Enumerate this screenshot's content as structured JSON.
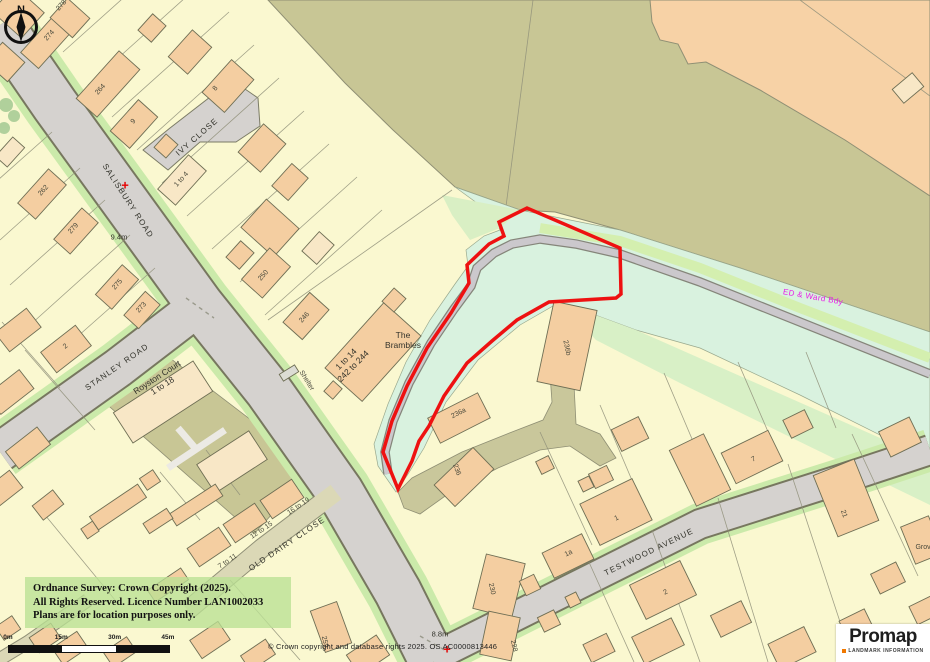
{
  "map": {
    "labels": [
      {
        "text": "SALISBURY ROAD",
        "x": 128,
        "y": 201,
        "rot": 57,
        "cls": "road"
      },
      {
        "text": "STANLEY ROAD",
        "x": 117,
        "y": 367,
        "rot": -35,
        "cls": "road"
      },
      {
        "text": "IVY CLOSE",
        "x": 197,
        "y": 137,
        "rot": -41,
        "cls": "road"
      },
      {
        "text": "OLD DAIRY CLOSE",
        "x": 287,
        "y": 544,
        "rot": -34,
        "cls": "road"
      },
      {
        "text": "TESTWOOD AVENUE",
        "x": 649,
        "y": 552,
        "rot": -26,
        "cls": "road"
      },
      {
        "text": "The\nBrambles",
        "x": 403,
        "y": 341,
        "rot": 0,
        "cls": "place"
      },
      {
        "text": "1 to 14\n242 to 244",
        "x": 350,
        "y": 363,
        "rot": -45,
        "cls": "place"
      },
      {
        "text": "Royston Court\n1 to 18",
        "x": 160,
        "y": 382,
        "rot": -33,
        "cls": "place"
      },
      {
        "text": "Shelter",
        "x": 306,
        "y": 381,
        "rot": 58,
        "cls": "placesm"
      },
      {
        "text": "ED & Ward Bdy",
        "x": 813,
        "y": 297,
        "rot": 10,
        "cls": "bdy"
      },
      {
        "text": "9.4m",
        "x": 119,
        "y": 238,
        "rot": 0,
        "cls": "height"
      },
      {
        "text": "8.8m",
        "x": 440,
        "y": 635,
        "rot": 0,
        "cls": "height"
      },
      {
        "text": "+",
        "x": 125,
        "y": 186,
        "rot": 0,
        "cls": "cross"
      },
      {
        "text": "+",
        "x": 447,
        "y": 650,
        "rot": 0,
        "cls": "cross"
      },
      {
        "text": "278",
        "x": 62,
        "y": 6,
        "rot": -48,
        "cls": "num"
      },
      {
        "text": "274",
        "x": 50,
        "y": 36,
        "rot": -48,
        "cls": "num"
      },
      {
        "text": "264",
        "x": 101,
        "y": 90,
        "rot": -48,
        "cls": "num"
      },
      {
        "text": "8",
        "x": 216,
        "y": 89,
        "rot": -48,
        "cls": "num"
      },
      {
        "text": "9",
        "x": 134,
        "y": 122,
        "rot": -48,
        "cls": "num"
      },
      {
        "text": "1 to 4",
        "x": 182,
        "y": 180,
        "rot": -48,
        "cls": "num"
      },
      {
        "text": "262",
        "x": 44,
        "y": 191,
        "rot": -48,
        "cls": "num"
      },
      {
        "text": "279",
        "x": 74,
        "y": 229,
        "rot": -48,
        "cls": "num"
      },
      {
        "text": "275",
        "x": 118,
        "y": 285,
        "rot": -48,
        "cls": "num"
      },
      {
        "text": "273",
        "x": 142,
        "y": 308,
        "rot": -48,
        "cls": "num"
      },
      {
        "text": "2",
        "x": 66,
        "y": 347,
        "rot": -38,
        "cls": "num"
      },
      {
        "text": "250",
        "x": 264,
        "y": 276,
        "rot": -48,
        "cls": "num"
      },
      {
        "text": "246",
        "x": 305,
        "y": 318,
        "rot": -48,
        "cls": "num"
      },
      {
        "text": "236b",
        "x": 566,
        "y": 348,
        "rot": 78,
        "cls": "num"
      },
      {
        "text": "236a",
        "x": 459,
        "y": 414,
        "rot": -27,
        "cls": "num"
      },
      {
        "text": "236",
        "x": 456,
        "y": 470,
        "rot": 70,
        "cls": "num"
      },
      {
        "text": "230",
        "x": 491,
        "y": 589,
        "rot": 78,
        "cls": "num"
      },
      {
        "text": "228",
        "x": 513,
        "y": 646,
        "rot": 78,
        "cls": "num"
      },
      {
        "text": "259",
        "x": 324,
        "y": 642,
        "rot": 78,
        "cls": "num"
      },
      {
        "text": "1",
        "x": 617,
        "y": 519,
        "rot": -26,
        "cls": "num"
      },
      {
        "text": "1a",
        "x": 569,
        "y": 554,
        "rot": -26,
        "cls": "num"
      },
      {
        "text": "2",
        "x": 666,
        "y": 593,
        "rot": -26,
        "cls": "num"
      },
      {
        "text": "7",
        "x": 754,
        "y": 460,
        "rot": -26,
        "cls": "num"
      },
      {
        "text": "21",
        "x": 843,
        "y": 514,
        "rot": 72,
        "cls": "num"
      },
      {
        "text": "Grove",
        "x": 925,
        "y": 548,
        "rot": 0,
        "cls": "num"
      },
      {
        "text": "7 to 11",
        "x": 228,
        "y": 562,
        "rot": -34,
        "cls": "num"
      },
      {
        "text": "12 to 15",
        "x": 262,
        "y": 531,
        "rot": -34,
        "cls": "num"
      },
      {
        "text": "16 to 19",
        "x": 299,
        "y": 507,
        "rot": -34,
        "cls": "num"
      }
    ]
  },
  "compass": {
    "letter": "N"
  },
  "copyright_box": {
    "line1": "Ordnance Survey: Crown Copyright (2025).",
    "line2": "All Rights Reserved. Licence Number LAN1002033",
    "line3": "Plans are for location purposes only."
  },
  "scale_bar": {
    "ticks": [
      "0m",
      "15m",
      "30m",
      "45m"
    ]
  },
  "os_credit": {
    "text": "© Crown copyright and database rights 2025. OS AC0000813446"
  },
  "logo": {
    "brand": "Promap",
    "subtitle": "LANDMARK INFORMATION"
  },
  "colors": {
    "boundary_red": "#ee1111",
    "ward_boundary_magenta": "#e81ce8",
    "building_peach": "#f4cea1",
    "road_grey": "#d5d2cf",
    "rough_grass_olive": "#c8c695",
    "water_corridor_mint": "#d9f2df",
    "verge_green": "#cbeaaa",
    "base_yellow": "#faf8d0",
    "promap_orange": "#f07800"
  }
}
